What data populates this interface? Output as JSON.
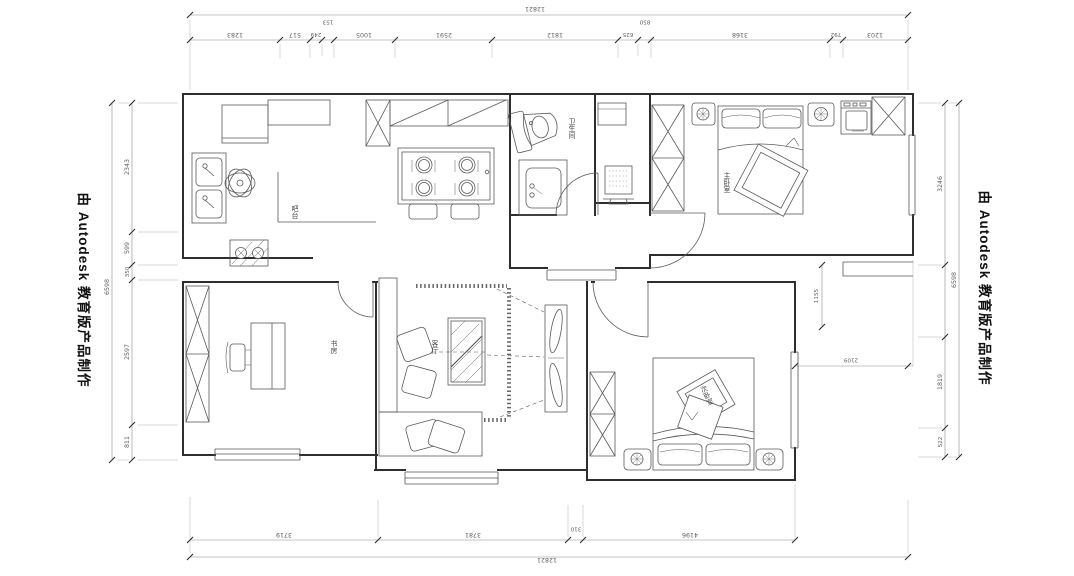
{
  "banner": {
    "text": "由 Autodesk 教育版产品制作"
  },
  "labels": {
    "bar": "吧台",
    "bathroom": "卫生间",
    "master_bedroom": "主卧室",
    "study": "书房",
    "living_room": "客厅",
    "second_bedroom": "次卧室"
  },
  "dimensions": {
    "top_overall": "12821",
    "top_chain": [
      "1283",
      "517",
      "249",
      "153",
      "1005",
      "2591",
      "1812",
      "625",
      "850",
      "3168",
      "792",
      "1203"
    ],
    "bottom_chain": [
      "3719",
      "3781",
      "310",
      "4196"
    ],
    "bottom_overall": "12821",
    "left_chain": [
      "2343",
      "599",
      "350",
      "2597",
      "811"
    ],
    "left_overall": "6598",
    "right_chain": [
      "3246",
      "1819",
      "522"
    ],
    "right_overall": "6598",
    "interior_vertical": "1155",
    "interior_horizontal": "2109"
  }
}
